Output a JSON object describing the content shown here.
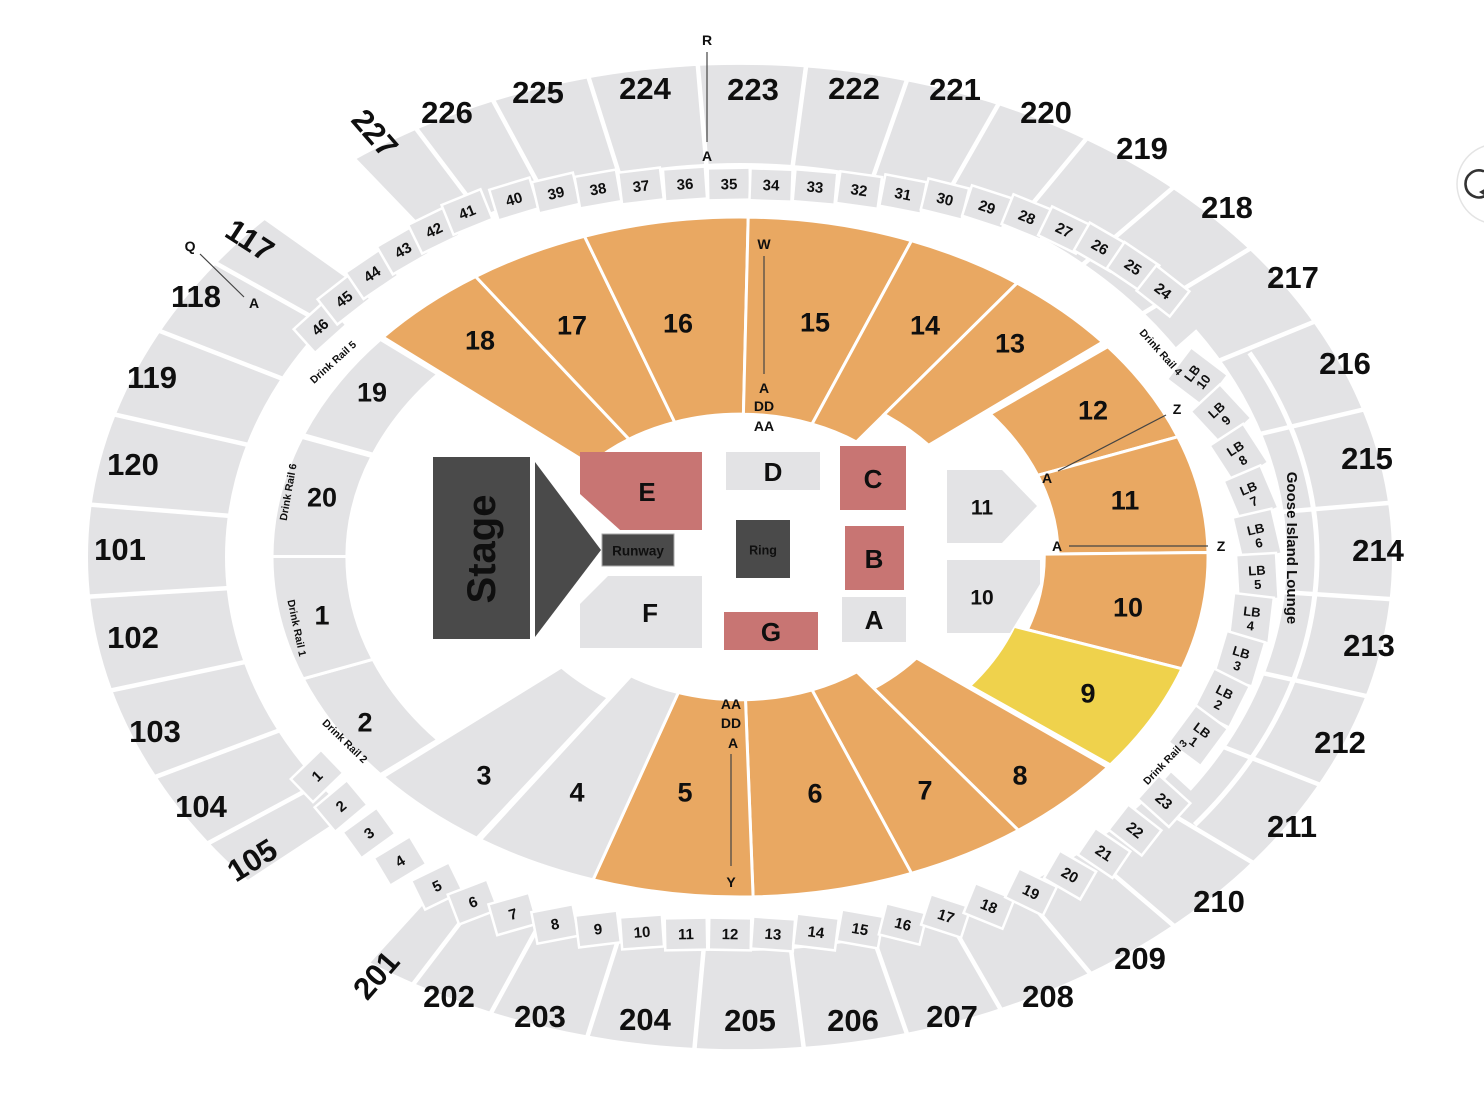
{
  "map_title": "Arena Seating Map",
  "colors": {
    "section_gray": "#e3e3e5",
    "tier_orange": "#e9a862",
    "tier_yellow": "#efd24c",
    "floor_red": "#c87573",
    "stage_dark": "#4a4a4a",
    "label_dark": "#0f0f0f",
    "marker_line": "#444444"
  },
  "outer_sections": [
    "227",
    "226",
    "225",
    "224",
    "223",
    "222",
    "221",
    "220",
    "219",
    "218",
    "217",
    "216",
    "215",
    "214",
    "213",
    "212",
    "211",
    "210",
    "209",
    "208",
    "207",
    "206",
    "205",
    "204",
    "203",
    "202",
    "201",
    "105",
    "104",
    "103",
    "102",
    "101",
    "120",
    "119",
    "118",
    "117"
  ],
  "upper_rows": [
    "46",
    "45",
    "44",
    "43",
    "42",
    "41",
    "40",
    "39",
    "38",
    "37",
    "36",
    "35",
    "34",
    "33",
    "32",
    "31",
    "30",
    "29",
    "28",
    "27",
    "26",
    "25",
    "24"
  ],
  "lower_rows": [
    "1",
    "2",
    "3",
    "4",
    "5",
    "6",
    "7",
    "8",
    "9",
    "10",
    "11",
    "12",
    "13",
    "14",
    "15",
    "16",
    "17",
    "18",
    "19",
    "20",
    "21",
    "22",
    "23"
  ],
  "mid_sections": [
    {
      "label": "19",
      "color_key": "section_gray"
    },
    {
      "label": "18",
      "color_key": "tier_orange"
    },
    {
      "label": "17",
      "color_key": "tier_orange"
    },
    {
      "label": "16",
      "color_key": "tier_orange"
    },
    {
      "label": "15",
      "color_key": "tier_orange"
    },
    {
      "label": "14",
      "color_key": "tier_orange"
    },
    {
      "label": "13",
      "color_key": "tier_orange"
    },
    {
      "label": "12",
      "color_key": "tier_orange"
    },
    {
      "label": "11",
      "color_key": "tier_orange"
    },
    {
      "label": "10",
      "color_key": "tier_orange"
    },
    {
      "label": "9",
      "color_key": "tier_yellow"
    },
    {
      "label": "8",
      "color_key": "tier_orange"
    },
    {
      "label": "7",
      "color_key": "tier_orange"
    },
    {
      "label": "6",
      "color_key": "tier_orange"
    },
    {
      "label": "5",
      "color_key": "tier_orange"
    },
    {
      "label": "4",
      "color_key": "section_gray"
    },
    {
      "label": "3",
      "color_key": "section_gray"
    },
    {
      "label": "2",
      "color_key": "section_gray"
    },
    {
      "label": "1",
      "color_key": "section_gray"
    },
    {
      "label": "20",
      "color_key": "section_gray"
    }
  ],
  "lb_boxes": {
    "prefix": "LB",
    "rows": [
      "10",
      "9",
      "8",
      "7",
      "6",
      "5",
      "4",
      "3",
      "2",
      "1"
    ]
  },
  "drink_rails": [
    "Drink Rail 5",
    "Drink Rail 6",
    "Drink Rail 1",
    "Drink Rail 2",
    "Drink Rail 4",
    "Drink Rail 3"
  ],
  "lounge_label": "Goose Island Lounge",
  "floor": {
    "stage": "Stage",
    "runway": "Runway",
    "ring": "Ring",
    "sections": [
      {
        "label": "E",
        "color_key": "floor_red"
      },
      {
        "label": "D",
        "color_key": "section_gray"
      },
      {
        "label": "C",
        "color_key": "floor_red"
      },
      {
        "label": "B",
        "color_key": "floor_red"
      },
      {
        "label": "A",
        "color_key": "section_gray"
      },
      {
        "label": "F",
        "color_key": "section_gray"
      },
      {
        "label": "G",
        "color_key": "floor_red"
      },
      {
        "label": "11",
        "color_key": "section_gray"
      },
      {
        "label": "10",
        "color_key": "section_gray"
      }
    ]
  },
  "row_markers": {
    "top": [
      "R",
      "A"
    ],
    "left": [
      "Q",
      "A"
    ],
    "sec15": [
      "W",
      "A",
      "DD",
      "AA"
    ],
    "sec5": [
      "AA",
      "DD",
      "A",
      "Y"
    ],
    "sec12": [
      "Z",
      "A"
    ],
    "sec11": [
      "A",
      "Z"
    ]
  },
  "icons": {
    "rotate": "rotate-icon"
  }
}
